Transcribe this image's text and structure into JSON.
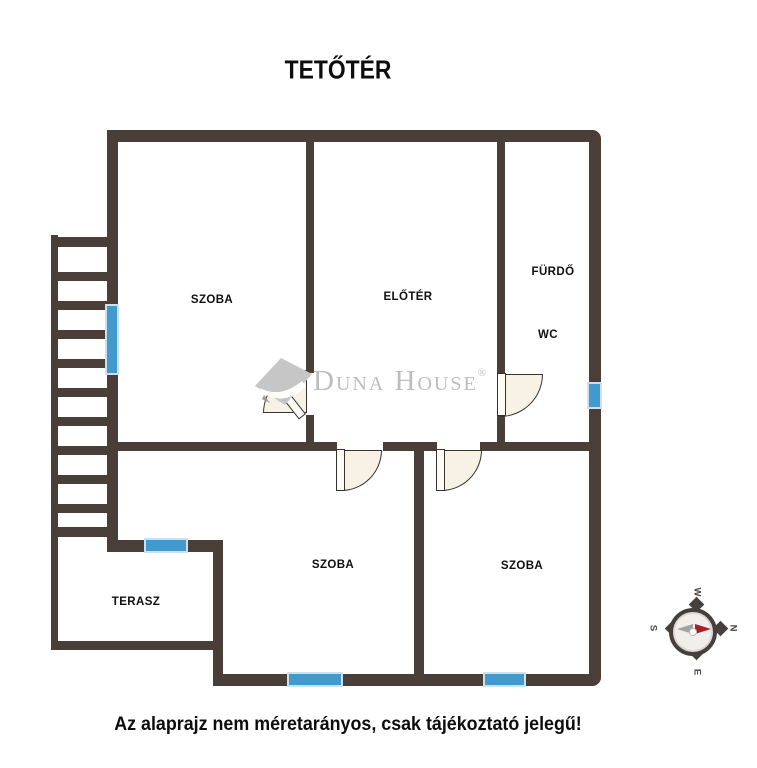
{
  "title": "TETŐTÉR",
  "caption": "Az alaprajz nem méretarányos, csak tájékoztató jelegű!",
  "watermark": {
    "brand": "Duna House",
    "registered": "®"
  },
  "rooms": [
    {
      "id": "szoba-top-left",
      "label": "SZOBA"
    },
    {
      "id": "eloter",
      "label": "ELŐTÉR"
    },
    {
      "id": "furdo",
      "label": "FÜRDŐ"
    },
    {
      "id": "wc",
      "label": "WC"
    },
    {
      "id": "terasz",
      "label": "TERASZ"
    },
    {
      "id": "szoba-bottom-middle",
      "label": "SZOBA"
    },
    {
      "id": "szoba-bottom-right",
      "label": "SZOBA"
    }
  ],
  "compass": {
    "north": "N",
    "east": "E",
    "south": "S",
    "west": "W",
    "rotation_deg": 90,
    "needle_points": "N"
  },
  "colors": {
    "wall": "#4A3E38",
    "window_blue": "#4199CC",
    "door_fill": "#F8F1E5",
    "watermark_gray": "#BDBDBD",
    "compass_red": "#A81E2D"
  }
}
